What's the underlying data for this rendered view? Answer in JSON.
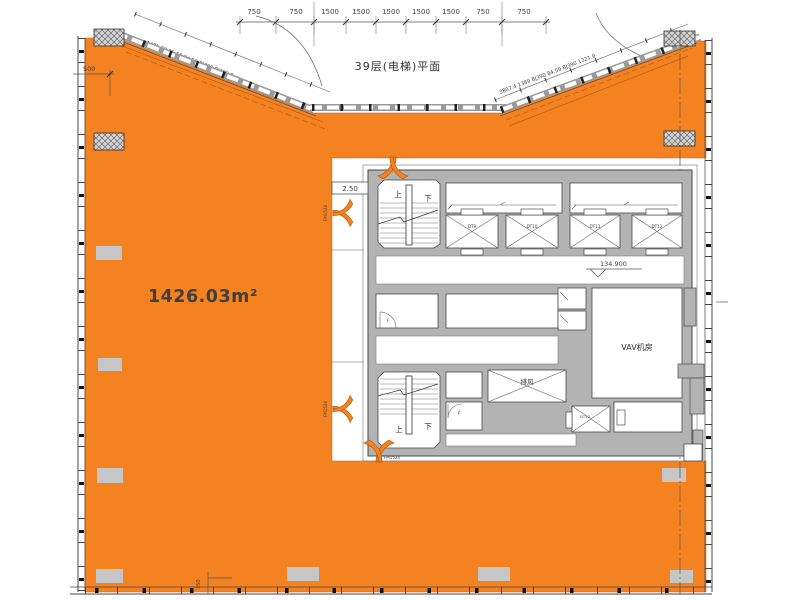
{
  "title": "39层(电梯)平面",
  "floor": {
    "area_label": "1426.03m²"
  },
  "core": {
    "vav_room": "VAV机房",
    "exhaust_shaft": "排风",
    "level_mark": "134.900",
    "sill_mark": "2.50",
    "stair_up": "上",
    "stair_down": "下",
    "door_tag": "F",
    "fire_door": "FM1524",
    "elevators": [
      "DT9",
      "DT10",
      "DT11",
      "DT12",
      "DT13"
    ]
  },
  "dimensions": {
    "top": [
      "750",
      "750",
      "1500",
      "1500",
      "1500",
      "1500",
      "1500",
      "750",
      "750"
    ],
    "left": "500",
    "bottom": "150",
    "diag_left": "1421 29.05 59 84.59 BJ390 BJ389.8",
    "diag_left_note": "钢支柱石幕墙",
    "diag_right": "3807.4 1389 BJ390 84.59 BJ390 1321.9"
  },
  "colors": {
    "floor": "#F58220",
    "wall": "#b3b3b3",
    "column": "#c6c6c6",
    "line": "#3f3f3f"
  }
}
